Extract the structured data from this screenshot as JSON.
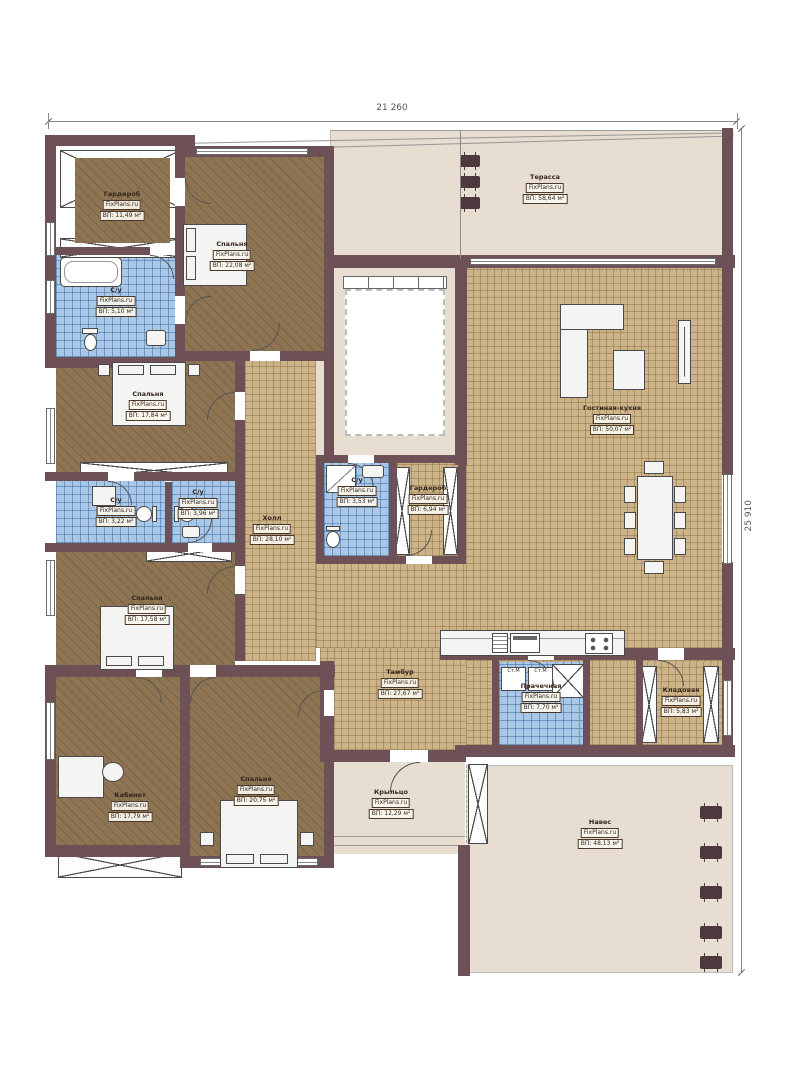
{
  "watermark": "FixPlans.ru",
  "dimensions": {
    "width_mm": "21 260",
    "height_mm": "25 910"
  },
  "rooms": [
    {
      "name": "Гардероб",
      "area": "ВП: 11,49 м²"
    },
    {
      "name": "Спальня",
      "area": "ВП: 22,08 м²"
    },
    {
      "name": "С/у",
      "area": "ВП: 5,10 м²"
    },
    {
      "name": "Терасса",
      "area": "ВП: 58,64 м²"
    },
    {
      "name": "Спальня",
      "area": "ВП: 17,84 м²"
    },
    {
      "name": "Гостиная-кухня",
      "area": "ВП: 50,07 м²"
    },
    {
      "name": "С/у",
      "area": "ВП: 3,22 м²"
    },
    {
      "name": "С/у",
      "area": "ВП: 3,96 м²"
    },
    {
      "name": "Холл",
      "area": "ВП: 28,10 м²"
    },
    {
      "name": "С/у",
      "area": "ВП: 3,53 м²"
    },
    {
      "name": "Гардероб",
      "area": "ВП: 6,94 м²"
    },
    {
      "name": "Спальня",
      "area": "ВП: 17,58 м²"
    },
    {
      "name": "Тамбур",
      "area": "ВП: 27,67 м²"
    },
    {
      "name": "Прачечная",
      "area": "ВП: 7,70 м²"
    },
    {
      "name": "Кладовая",
      "area": "ВП: 5,83 м²"
    },
    {
      "name": "Кабинет",
      "area": "ВП: 17,79 м²"
    },
    {
      "name": "Спальня",
      "area": "ВП: 20,75 м²"
    },
    {
      "name": "Крыльцо",
      "area": "ВП: 12,29 м²"
    },
    {
      "name": "Навес",
      "area": "ВП: 48,13 м²"
    }
  ],
  "appliances": {
    "washer": "Ст.М"
  },
  "colors": {
    "wall": "#6d5157",
    "wood_floor": "#8d7453",
    "plaid_floor": "#ccb388",
    "tile_floor": "#a9c7e6",
    "outdoor_floor": "#e7ddd0"
  }
}
